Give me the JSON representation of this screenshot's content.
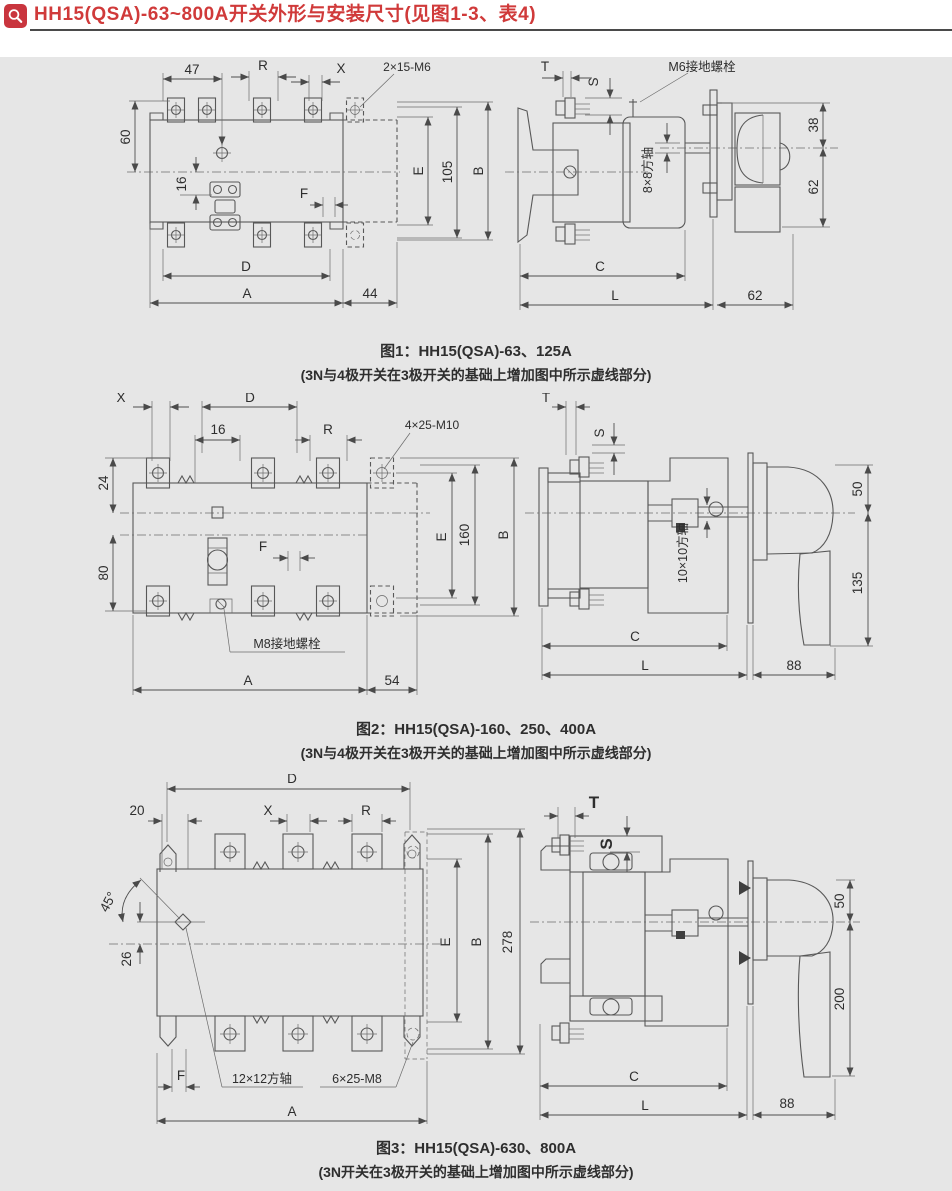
{
  "header": {
    "title": "HH15(QSA)-63~800A开关外形与安装尺寸(见图1-3、表4)",
    "icon": "magnifier"
  },
  "fig1": {
    "front": {
      "d47": "47",
      "R": "R",
      "X": "X",
      "screw": "2×15-M6",
      "d60": "60",
      "d16": "16",
      "F": "F",
      "E": "E",
      "d105": "105",
      "B": "B",
      "D": "D",
      "A": "A",
      "d44": "44"
    },
    "side": {
      "T": "T",
      "S": "S",
      "ground": "M6接地螺栓",
      "shaft": "8×8方轴",
      "d38": "38",
      "d62": "62",
      "C": "C",
      "L": "L",
      "d62b": "62"
    },
    "caption": "图1：HH15(QSA)-63、125A",
    "note": "(3N与4极开关在3极开关的基础上增加图中所示虚线部分)"
  },
  "fig2": {
    "front": {
      "X": "X",
      "D": "D",
      "d16": "16",
      "R": "R",
      "screw": "4×25-M10",
      "d24": "24",
      "d80": "80",
      "F": "F",
      "E": "E",
      "d160": "160",
      "B": "B",
      "ground": "M8接地螺栓",
      "A": "A",
      "d54": "54"
    },
    "side": {
      "T": "T",
      "S": "S",
      "shaft": "10×10方轴",
      "d50": "50",
      "d135": "135",
      "C": "C",
      "L": "L",
      "d88": "88"
    },
    "caption": "图2：HH15(QSA)-160、250、400A",
    "note": "(3N与4极开关在3极开关的基础上增加图中所示虚线部分)"
  },
  "fig3": {
    "front": {
      "D": "D",
      "d20": "20",
      "X": "X",
      "R": "R",
      "deg45": "45°",
      "d26": "26",
      "E": "E",
      "B": "B",
      "d278": "278",
      "F": "F",
      "shaft": "12×12方轴",
      "screw": "6×25-M8",
      "A": "A"
    },
    "side": {
      "T": "T",
      "S": "S",
      "d50": "50",
      "d200": "200",
      "C": "C",
      "L": "L",
      "d88": "88"
    },
    "caption": "图3：HH15(QSA)-630、800A",
    "note": "(3N开关在3极开关的基础上增加图中所示虚线部分)"
  }
}
